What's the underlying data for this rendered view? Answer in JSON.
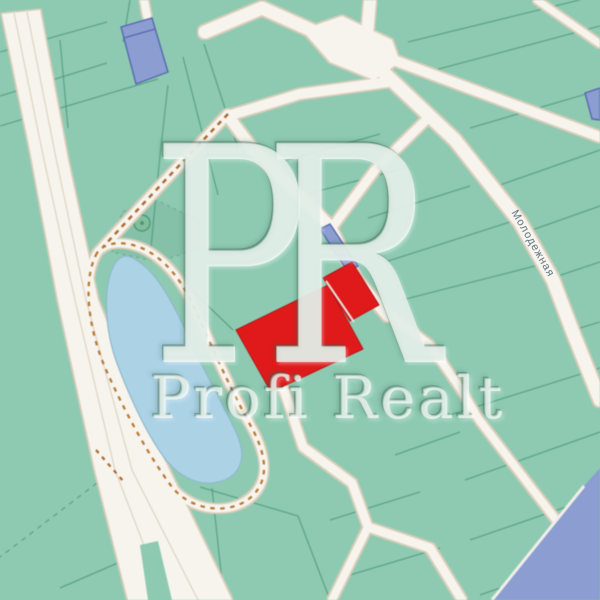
{
  "watermark": {
    "monogram": "PR",
    "brand": "Profi Realt"
  },
  "street_label": {
    "text": "Молодежная"
  },
  "colors": {
    "land": "#8ecab2",
    "vegetation": "#84bfa7",
    "parcel_line": "#4f9a7c",
    "road_fill": "#f7f4ed",
    "road_edge": "#d8cdba",
    "dirt_track_dash": "#a8682e",
    "lake_water": "#abd2e5",
    "lake_shore_dash": "#b5762f",
    "building_fill": "#8c9dd1",
    "building_outline": "#5668ae",
    "highlight_parcel": "#e01a1a",
    "watermark_tint": "#cde7db"
  }
}
